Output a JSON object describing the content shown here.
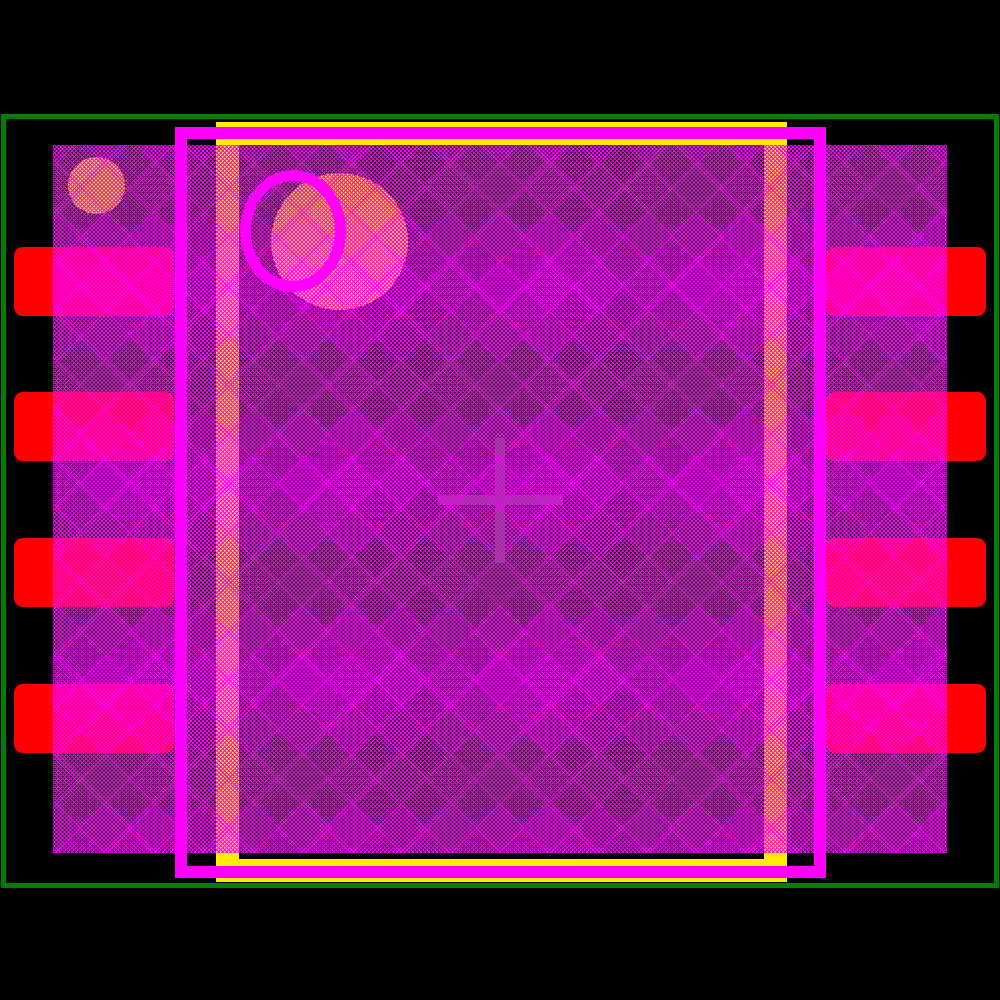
{
  "window": {
    "width": 1000,
    "height": 1000,
    "description": "PCB footprint land-pattern preview, 8-pad dual-row package, no visible text"
  },
  "colors": {
    "background": "#000000",
    "courtyard": "#008000",
    "silkscreen": "#ff00ff",
    "fab": "#ffec00",
    "pad_copper": "#ff0000",
    "hatch_lines": "#ff00ff",
    "origin_cross": "#118a11"
  },
  "shapes": {
    "courtyard_outline": {
      "x": 1,
      "y": 114,
      "width": 998,
      "height": 774,
      "stroke": 5
    },
    "body_hatch_region": {
      "x": 53,
      "y": 145,
      "width": 894,
      "height": 708,
      "hatch_period": 2.8,
      "hatch_line_width": 1.1
    },
    "fab_outline": {
      "x": 216,
      "y": 122,
      "width": 571,
      "height": 760,
      "stroke": 23
    },
    "silkscreen_outline": {
      "x": 175,
      "y": 127,
      "width": 651,
      "height": 751,
      "stroke": 12
    },
    "silkscreen_pin1_circle": {
      "x": 240,
      "y": 170,
      "width": 106,
      "height": 122,
      "stroke": 11
    },
    "fab_pin1_dot_small": {
      "x": 68,
      "y": 157,
      "width": 57,
      "height": 57
    },
    "fab_pin1_dot_large": {
      "x": 271,
      "y": 173,
      "width": 137,
      "height": 137
    },
    "origin_cross": {
      "cx": 500,
      "cy": 500,
      "arm_span": 125,
      "thickness": 10
    },
    "pads": {
      "width": 160,
      "height": 69,
      "corner_radius": 9,
      "items": [
        {
          "name": "pad-left-1",
          "x": 14,
          "y": 247
        },
        {
          "name": "pad-left-2",
          "x": 14,
          "y": 392
        },
        {
          "name": "pad-left-3",
          "x": 14,
          "y": 538
        },
        {
          "name": "pad-left-4",
          "x": 14,
          "y": 684
        },
        {
          "name": "pad-right-1",
          "x": 826,
          "y": 247
        },
        {
          "name": "pad-right-2",
          "x": 826,
          "y": 392
        },
        {
          "name": "pad-right-3",
          "x": 826,
          "y": 538
        },
        {
          "name": "pad-right-4",
          "x": 826,
          "y": 684
        }
      ]
    }
  }
}
